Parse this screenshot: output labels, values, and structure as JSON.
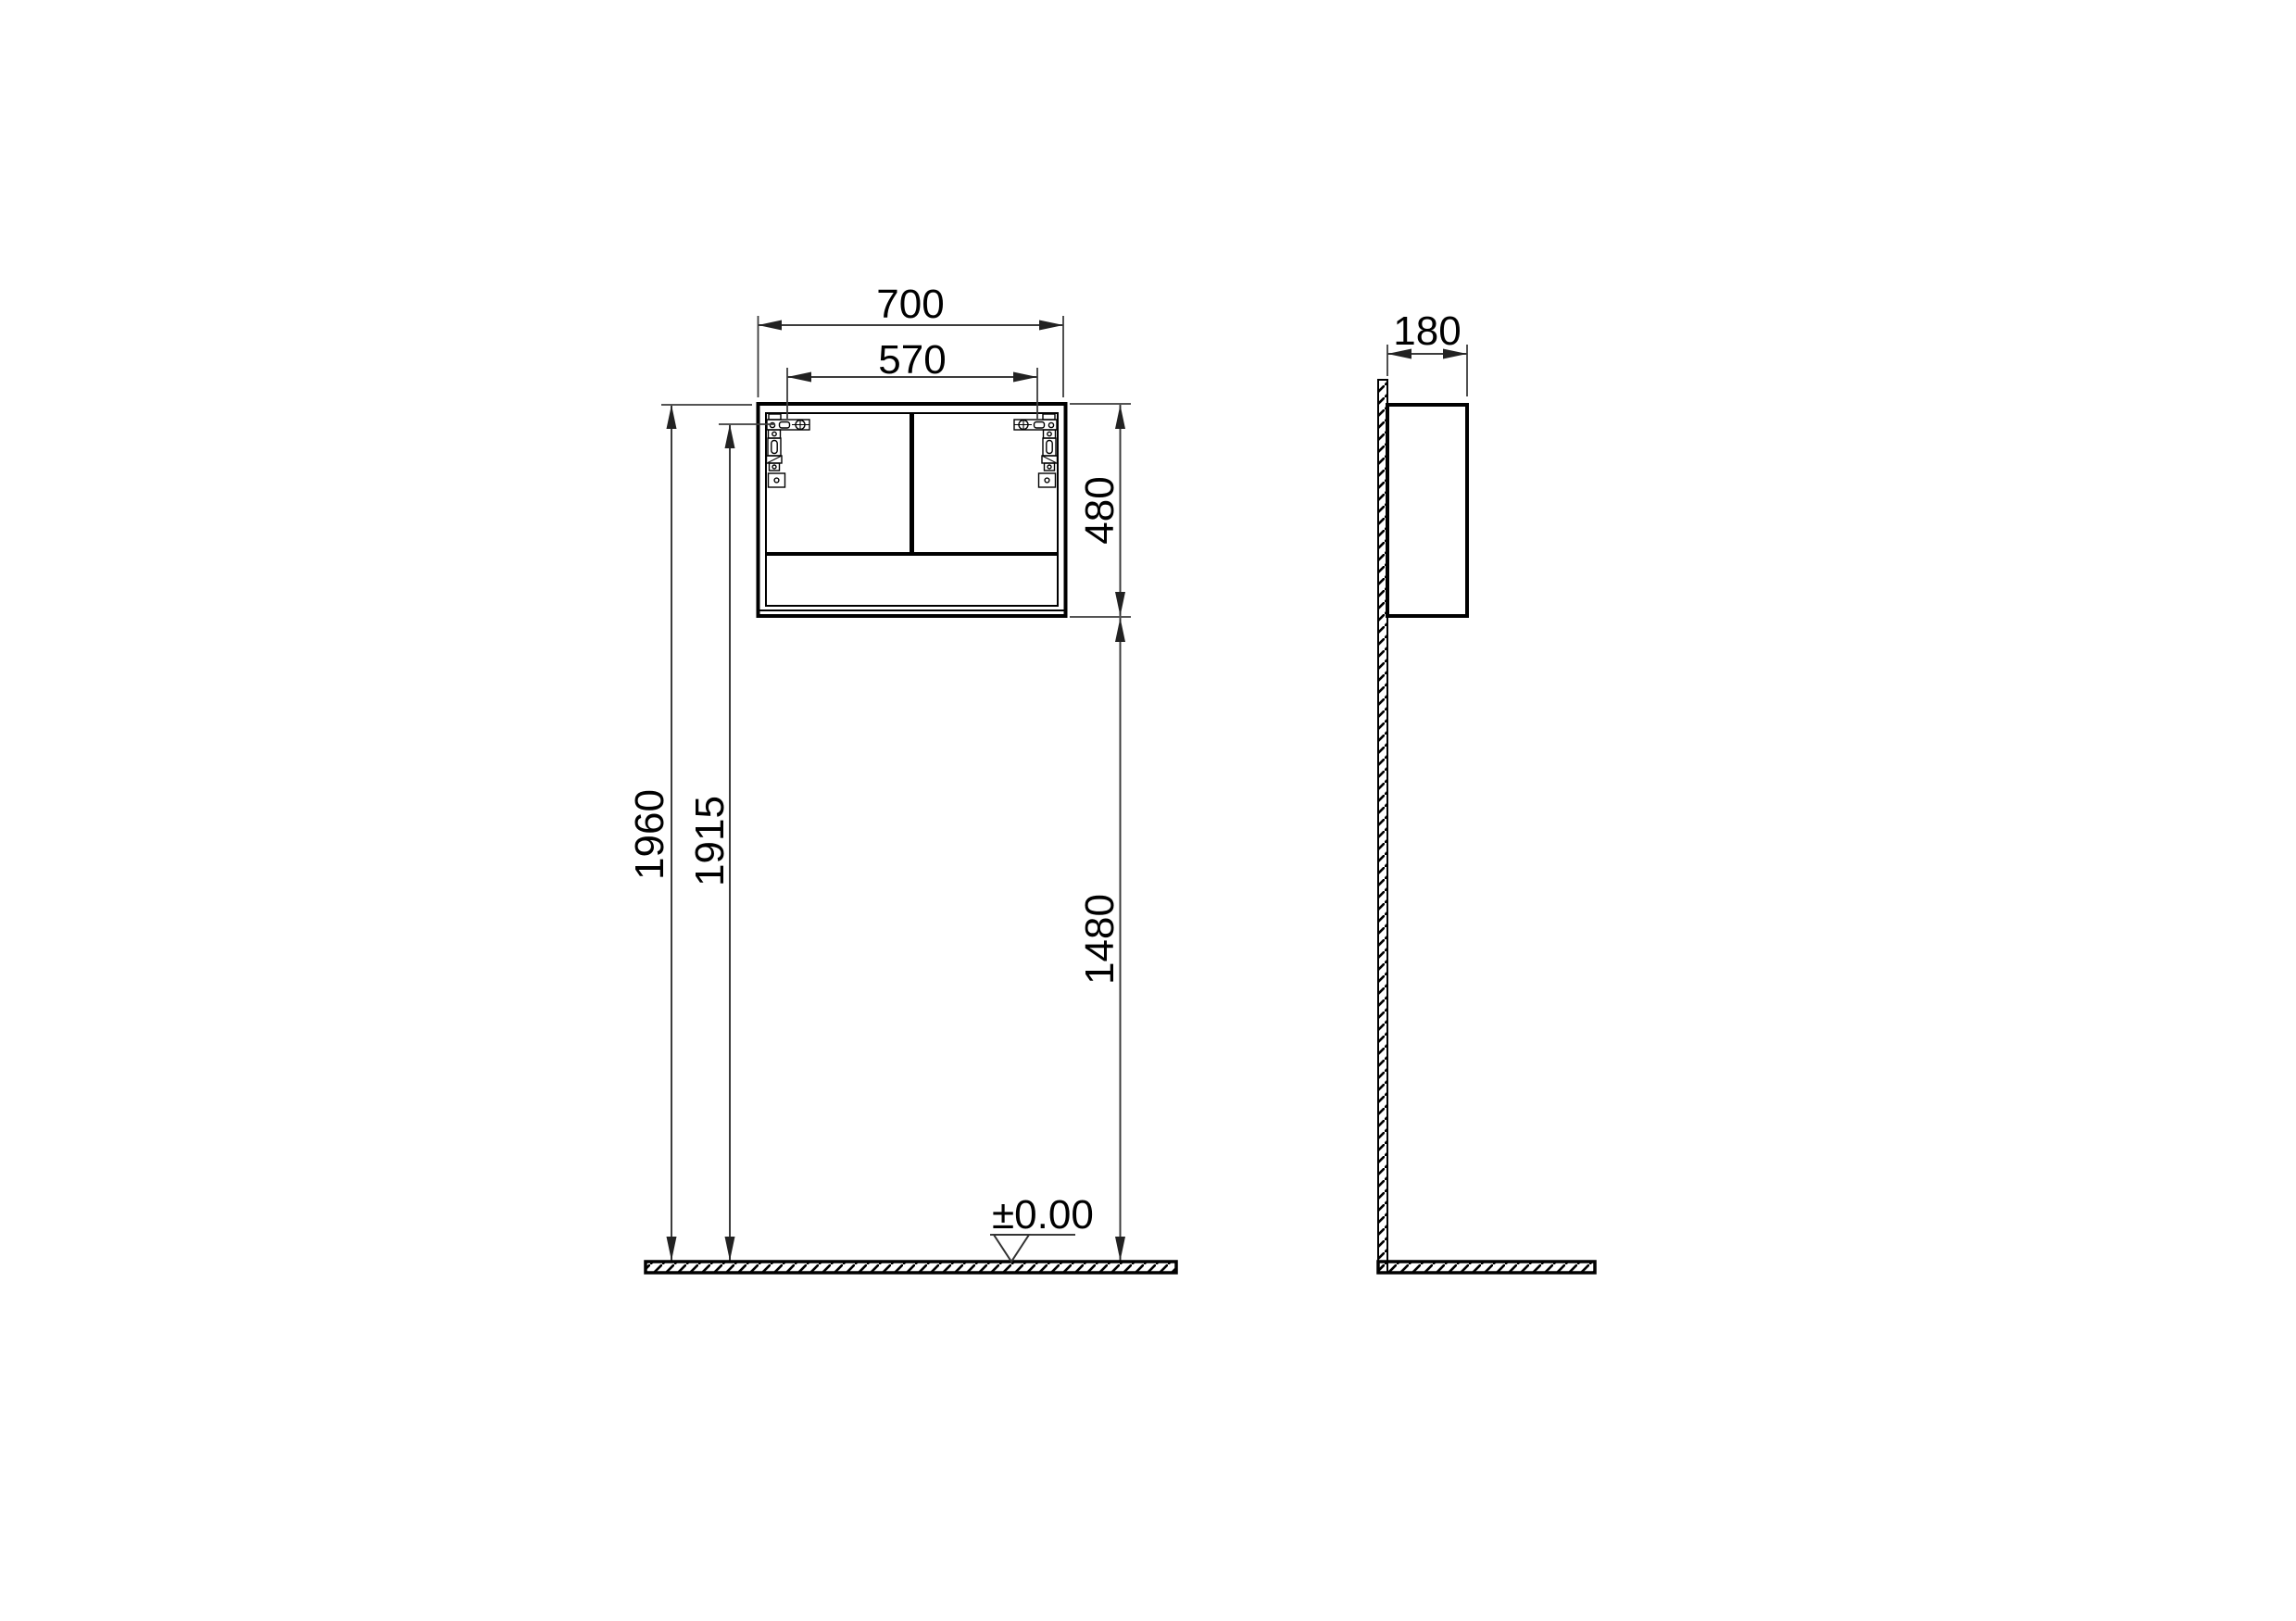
{
  "colors": {
    "background": "#ffffff",
    "ink": "#000000",
    "dim_line": "#3c3c3c"
  },
  "front": {
    "dims": {
      "overall_width": "700",
      "fixing_centers": "570",
      "cabinet_height": "480",
      "overall_height": "1960",
      "fixing_height": "1915",
      "clearance_height": "1480",
      "datum_level": "±0.00"
    }
  },
  "side": {
    "dims": {
      "depth": "180"
    }
  }
}
